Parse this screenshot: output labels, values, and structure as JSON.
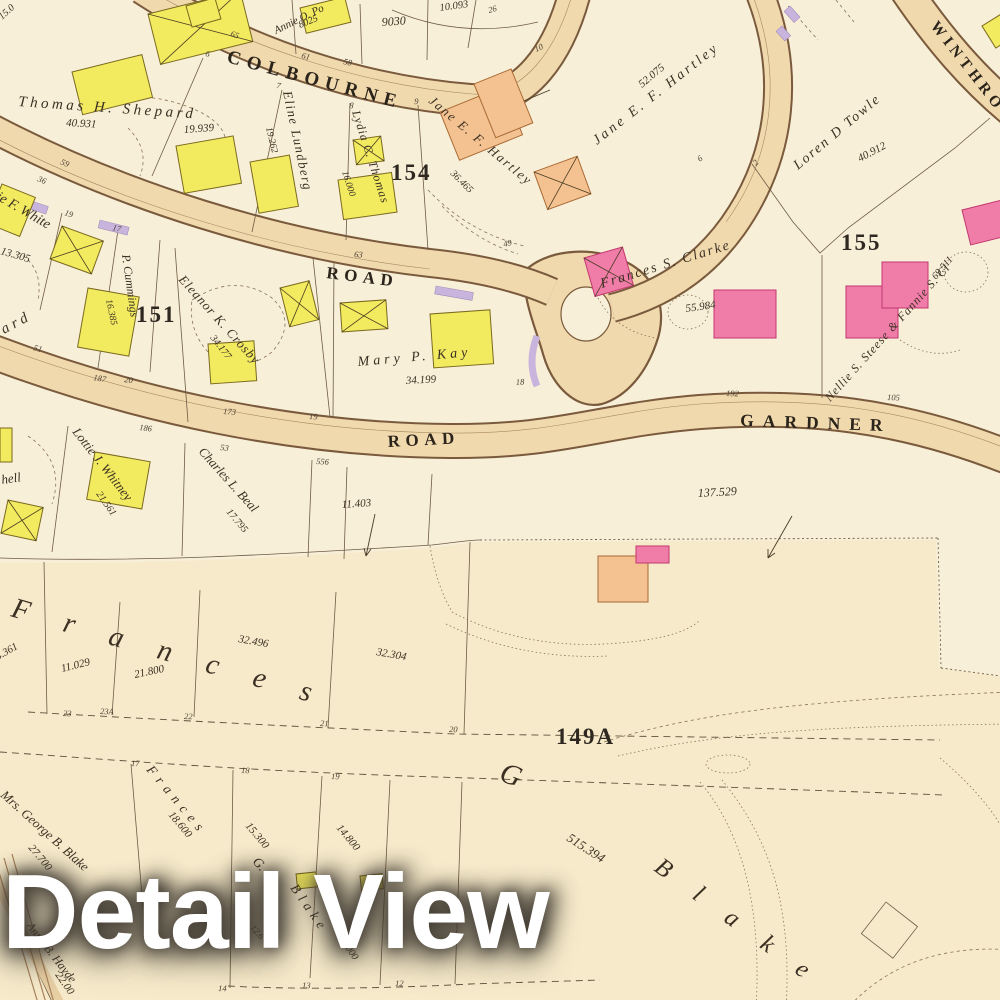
{
  "overlay": {
    "title": "Detail View"
  },
  "map": {
    "roads": {
      "colbourne": "COLBOURNE",
      "road_upper": "ROAD",
      "road_lower": "ROAD",
      "gardner": "GARDNER",
      "winthrop": "WINTHRO"
    },
    "districts": {
      "b151": "151",
      "b154": "154",
      "b155": "155",
      "b149a": "149A"
    },
    "labels": {
      "shepard": "Thomas H. Shepard",
      "shepard_area": "40.931",
      "lot19939": "19.939",
      "lundberg": "Eline Lundberg",
      "lundberg_area": "19.262",
      "annie": "Annie O. Po",
      "annie_area": "8025",
      "n9030": "9030",
      "n10093": "10.093",
      "n150": "15.0",
      "lydia": "Lydia C. Thomas",
      "lydia_area": "16.000",
      "hartley_small": "Jane E. F. Hartley",
      "hartley_small_area": "36.465",
      "hartley_big": "Jane E. F. Hartley",
      "hartley_big_area": "52.075",
      "towle": "Loren D Towle",
      "towle_area": "40.912",
      "clarke": "Frances S. Clarke",
      "clarke_area": "55.984",
      "steese": "Nellie S. Steese & Fannie S. Cl",
      "steese_area": "69.511",
      "white": "Elsie F. White",
      "white_area": "13.305",
      "ard": "ard",
      "cummings": "P. Cummings",
      "cummings_area": "16.385",
      "crosby": "Eleanor K. Crosby",
      "crosby_area": "34.177",
      "kay": "Mary P. Kay",
      "kay_area": "34.199",
      "hell": "hell",
      "whitney": "Lottie J. Whitney",
      "whitney_area": "21.561",
      "beal": "Charles L. Beal",
      "beal_area": "17.795",
      "n11403": "11.403",
      "n137529": "137.529",
      "n4361": "4.361",
      "n11029": "11.029",
      "n21800": "21.800",
      "n32496": "32.496",
      "n32304": "32.304",
      "n515394": "515.394",
      "gblake": "Mrs. George B. Blake",
      "gblake_area": "27.700",
      "n18600": "18.600",
      "n15300": "15.300",
      "n14800": "14.800",
      "anna": "Anna B. Hayde",
      "anna_area": "22.00",
      "n12000": "12.000",
      "n126": "12.6"
    },
    "spread": {
      "frances_big": "Frances",
      "g_big": "G",
      "blake_big": "Blake",
      "frances_small": "Frances",
      "g_small": "G.",
      "blake_small": "Blake"
    },
    "ticks": [
      "65",
      "61",
      "58",
      "26",
      "6",
      "7",
      "8",
      "9",
      "10",
      "59",
      "36",
      "19",
      "17",
      "63",
      "49",
      "51",
      "187",
      "20",
      "186",
      "173",
      "19",
      "53",
      "556",
      "18",
      "192",
      "105",
      "23",
      "23A",
      "22",
      "21",
      "20",
      "17",
      "18",
      "19",
      "14",
      "13",
      "12",
      "6",
      "2"
    ]
  }
}
